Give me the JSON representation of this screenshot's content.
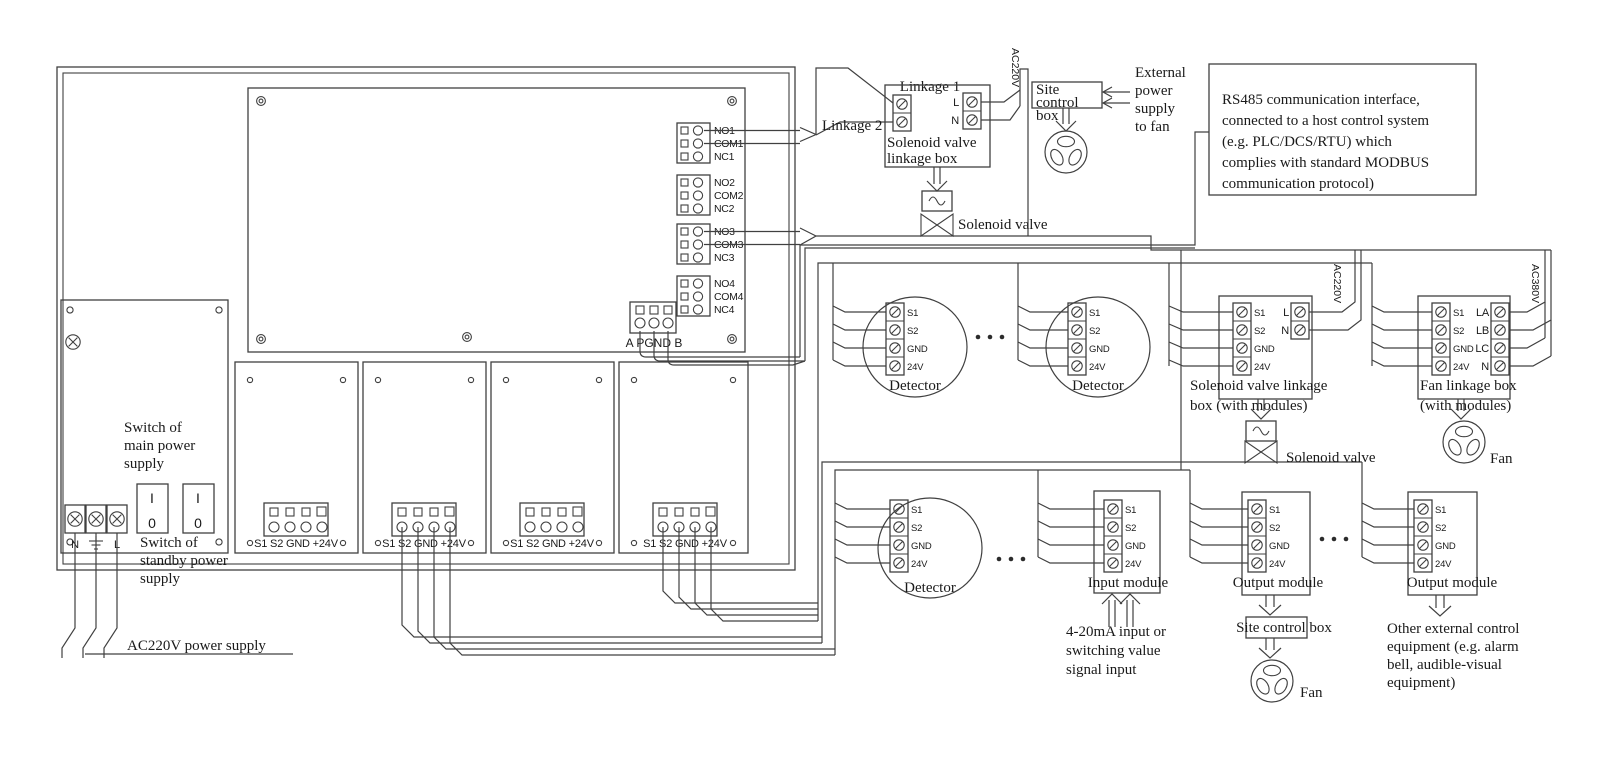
{
  "colors": {
    "line": "#404040",
    "text": "#1a1a1a",
    "background": "#ffffff"
  },
  "controller": {
    "relays": [
      [
        "NO1",
        "COM1",
        "NC1"
      ],
      [
        "NO2",
        "COM2",
        "NC2"
      ],
      [
        "NO3",
        "COM3",
        "NC3"
      ],
      [
        "NO4",
        "COM4",
        "NC4"
      ]
    ],
    "comm_terminals": "A PGND B",
    "card_terminals": "S1 S2 GND +24V",
    "switch_main": [
      "Switch of",
      "main power",
      "supply"
    ],
    "switch_standby": [
      "Switch of",
      "standby power",
      "supply"
    ],
    "switch_on": "I",
    "switch_off": "0",
    "power_n": "N",
    "power_l": "L",
    "power_supply": "AC220V power supply"
  },
  "top": {
    "linkage1": "Linkage 1",
    "linkage2": "Linkage 2",
    "sv_box": [
      "Solenoid valve",
      "linkage box"
    ],
    "l": "L",
    "n": "N",
    "ac220v": "AC220V",
    "solenoid_valve": "Solenoid valve",
    "site_box": [
      "Site",
      "control",
      "box"
    ],
    "external": [
      "External",
      "power",
      "supply",
      "to fan"
    ],
    "rs485": [
      "RS485 communication interface,",
      "connected to a host control system",
      "(e.g. PLC/DCS/RTU) which",
      "complies with standard MODBUS",
      "communication protocol)"
    ]
  },
  "terminals": [
    "S1",
    "S2",
    "GND",
    "24V"
  ],
  "upper_row": {
    "detector": "Detector",
    "sv_box": {
      "title": [
        "Solenoid valve linkage",
        "box (with modules)"
      ],
      "l": "L",
      "n": "N",
      "ac": "AC220V",
      "valve": "Solenoid valve"
    },
    "fan_box": {
      "title": [
        "Fan linkage box",
        "(with modules)"
      ],
      "phases": [
        "LA",
        "LB",
        "LC",
        "N"
      ],
      "ac": "AC380V",
      "fan": "Fan"
    }
  },
  "lower_row": {
    "detector": "Detector",
    "input": {
      "title": "Input module",
      "note": [
        "4-20mA input or",
        "switching value",
        "signal input"
      ]
    },
    "output1": {
      "title": "Output module",
      "site_box": "Site control box",
      "fan": "Fan"
    },
    "output2": {
      "title": "Output module",
      "note": [
        "Other external control",
        "equipment (e.g. alarm",
        "bell, audible-visual",
        "equipment)"
      ]
    }
  }
}
